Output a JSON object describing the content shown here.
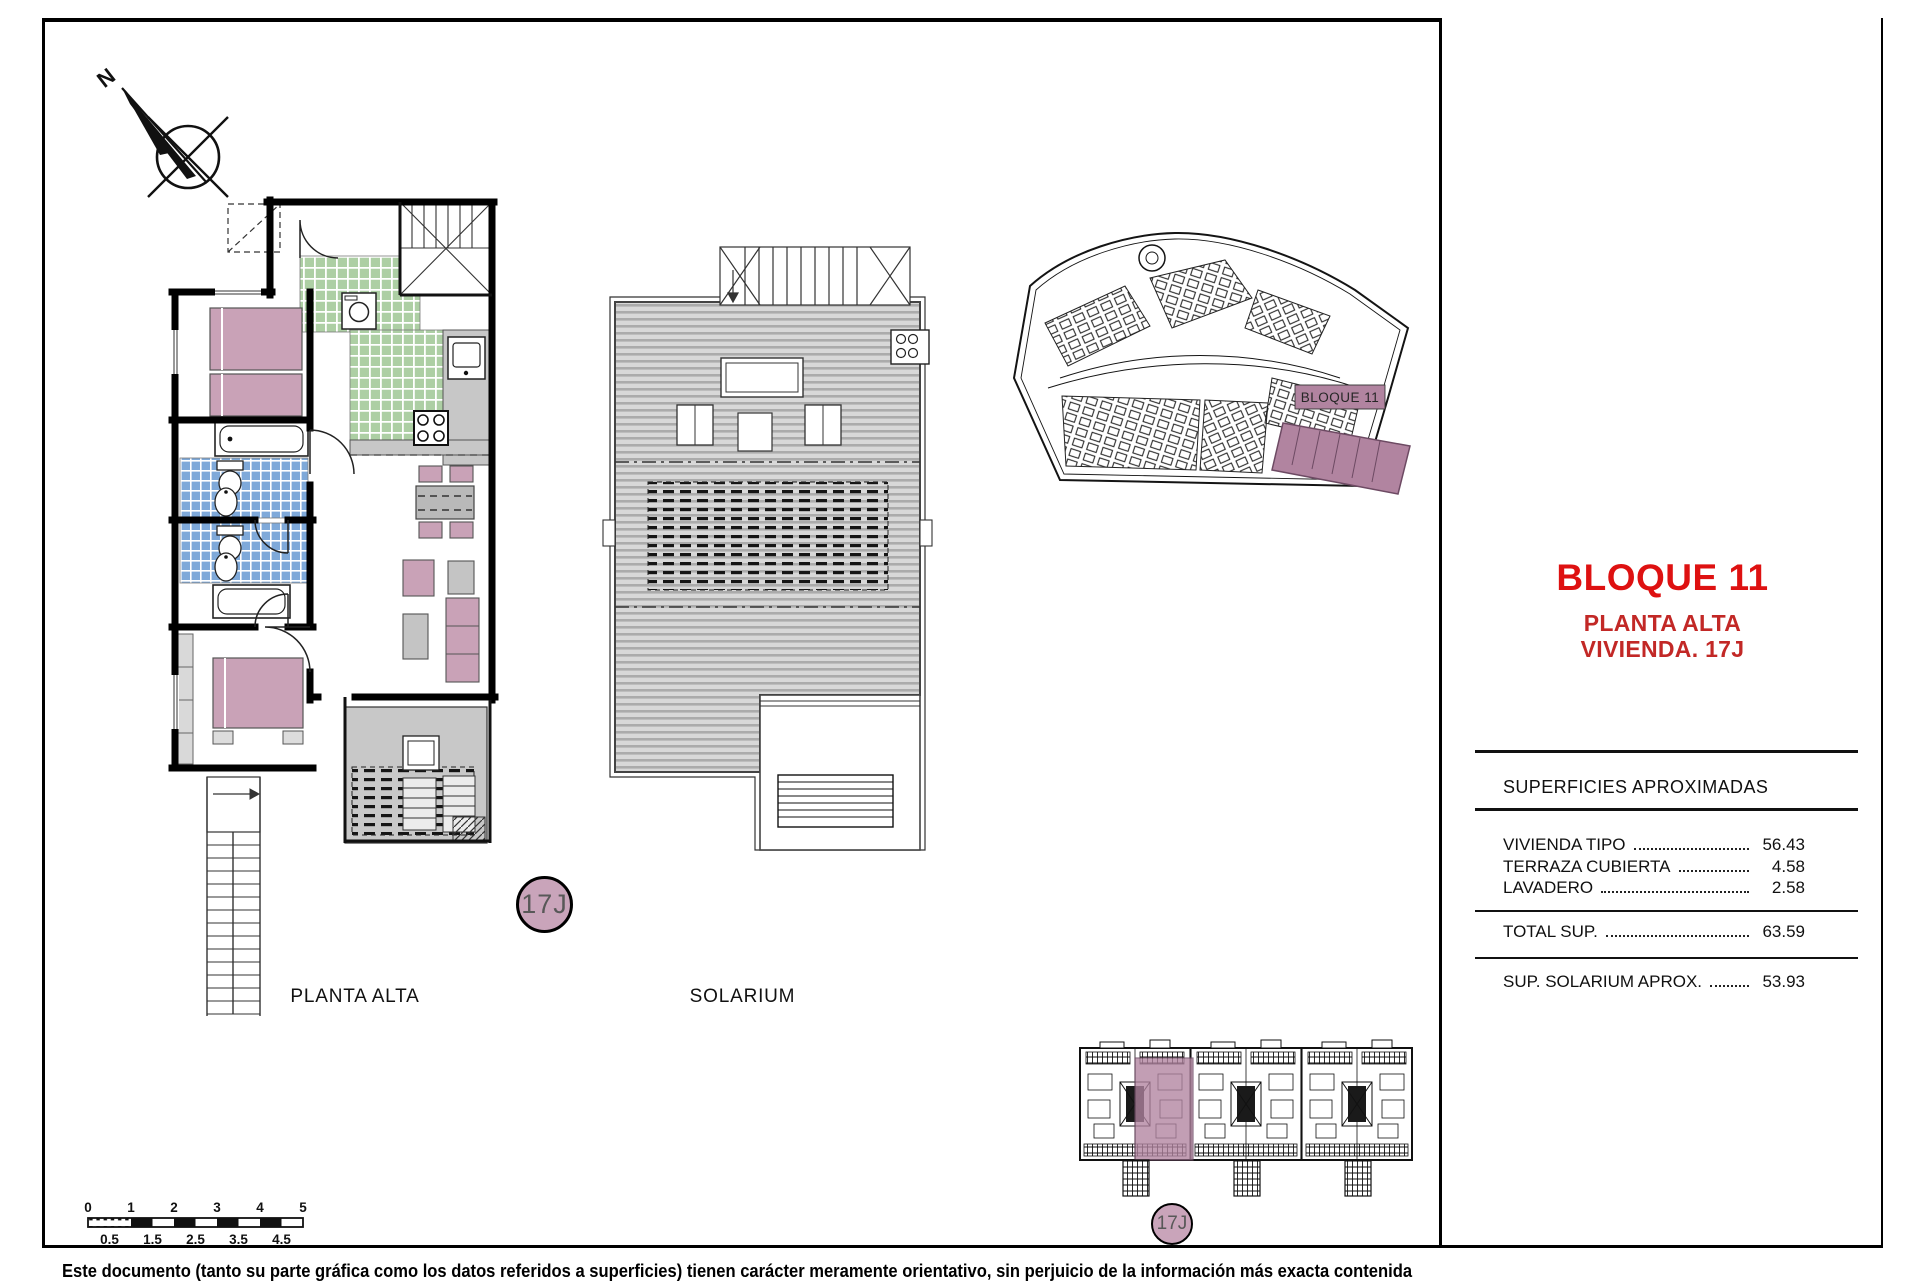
{
  "title_block": {
    "block": "BLOQUE 11",
    "line1": "PLANTA ALTA",
    "line2": "VIVIENDA. 17J"
  },
  "surfaces": {
    "header": "SUPERFICIES APROXIMADAS",
    "rows": [
      {
        "label": "VIVIENDA TIPO",
        "value": "56.43"
      },
      {
        "label": "TERRAZA CUBIERTA",
        "value": "4.58"
      },
      {
        "label": "LAVADERO",
        "value": "2.58"
      }
    ],
    "total_label": "TOTAL SUP.",
    "total_value": "63.59",
    "solarium_label": "SUP. SOLARIUM APROX.",
    "solarium_value": "53.93"
  },
  "labels": {
    "floor_plan": "PLANTA ALTA",
    "solarium": "SOLARIUM"
  },
  "badges": {
    "unit": "17J"
  },
  "site": {
    "block_label": "BLOQUE 11"
  },
  "compass": {
    "north": "N"
  },
  "scale_bar": {
    "top": [
      "0",
      "1",
      "2",
      "3",
      "4",
      "5"
    ],
    "bottom": [
      "0.5",
      "1.5",
      "2.5",
      "3.5",
      "4.5"
    ]
  },
  "footer": {
    "disclaimer": "Este documento (tanto su parte gráfica como los datos referidos a superficies) tienen carácter meramente orientativo, sin perjuicio de la información más exacta contenida"
  },
  "colors": {
    "title_red": "#de1111",
    "subtitle_red": "#c22826",
    "room_pink": "#c9a2b7",
    "site_mauve": "#b184a0",
    "tile_green": "#adcfa4",
    "tile_blue": "#7fa9d9",
    "terrace_gray": "#c8c8c8"
  }
}
